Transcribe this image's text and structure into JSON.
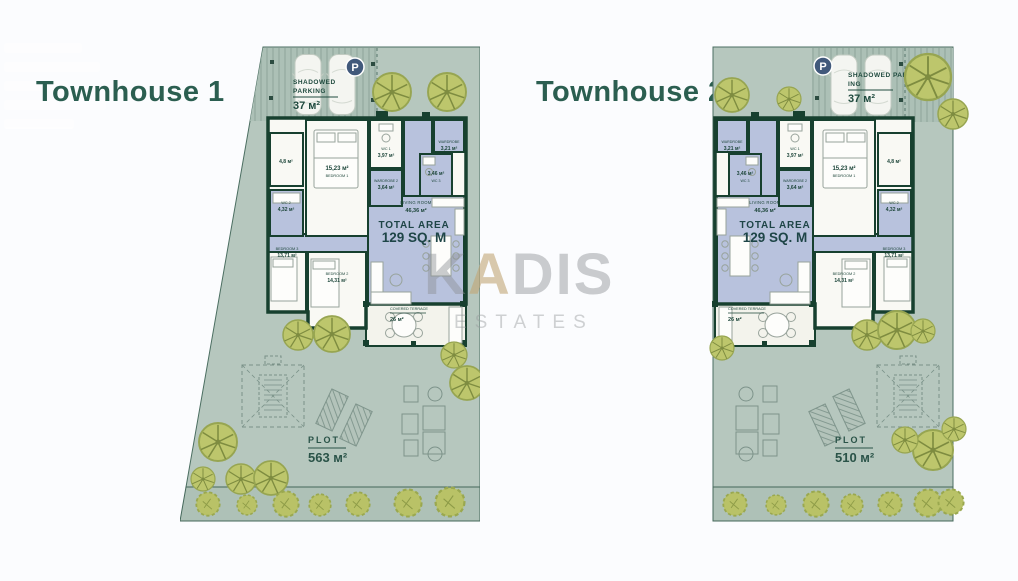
{
  "watermark": {
    "k": "K",
    "a": "A",
    "dis": "DIS",
    "sub": "ESTATES"
  },
  "townhouse1": {
    "title": "Townhouse 1",
    "parking": {
      "badge": "P",
      "line1": "SHADOWED",
      "line2": "PARKING",
      "area": "37 м²"
    },
    "rooms": {
      "storage": {
        "area": "4,8 м²"
      },
      "wc1": {
        "name": "WC 1",
        "area": "3,97 м²"
      },
      "wardrobe": {
        "name": "WARDROBE",
        "area": "3,21 м²"
      },
      "bedroom1": {
        "area": "15,23 м²",
        "name": "BEDROOM 1"
      },
      "wardrobe2": {
        "name": "WARDROBE 2",
        "area": "3,64 м²"
      },
      "wc3": {
        "area": "3,46 м²",
        "name": "WC 3"
      },
      "wc2": {
        "name": "WC 2",
        "area": "4,32 м²"
      },
      "living": {
        "name": "LIVING ROOM",
        "area": "46,36 м²"
      },
      "total": {
        "line1": "TOTAL AREA",
        "line2": "129 SQ. M"
      },
      "bedroom3": {
        "name": "BEDROOM 3",
        "area": "13,71 м²"
      },
      "bedroom2": {
        "name": "BEDROOM 2",
        "area": "14,31 м²"
      },
      "terrace": {
        "name": "COVERED TERRACE",
        "area": "26 м²"
      }
    },
    "plot": {
      "label": "PLOT",
      "area": "563 м²"
    }
  },
  "townhouse2": {
    "title": "Townhouse 2",
    "parking": {
      "badge": "P",
      "line1": "SHADOWED PARK-",
      "line2": "ING",
      "area": "37 м²"
    },
    "rooms": {
      "storage": {
        "area": "4,8 м²"
      },
      "wc1": {
        "name": "WC 1",
        "area": "3,97 м²"
      },
      "wardrobe": {
        "name": "WARDROBE",
        "area": "3,21 м²"
      },
      "bedroom1": {
        "area": "15,23 м²",
        "name": "BEDROOM 1"
      },
      "wardrobe2": {
        "name": "WARDROBE 2",
        "area": "3,64 м²"
      },
      "wc3": {
        "area": "3,46 м²",
        "name": "WC 3"
      },
      "wc2": {
        "name": "WC 2",
        "area": "4,32 м²"
      },
      "living": {
        "name": "LIVING ROOM",
        "area": "46,36 м²"
      },
      "total": {
        "line1": "TOTAL AREA",
        "line2": "129 SQ. M"
      },
      "bedroom3": {
        "name": "BEDROOM 3",
        "area": "13,71 м²"
      },
      "bedroom2": {
        "name": "BEDROOM 2",
        "area": "14,31 м²"
      },
      "terrace": {
        "name": "COVERED TERRACE",
        "area": "26 м²"
      }
    },
    "plot": {
      "label": "PLOT",
      "area": "510 м²"
    }
  }
}
